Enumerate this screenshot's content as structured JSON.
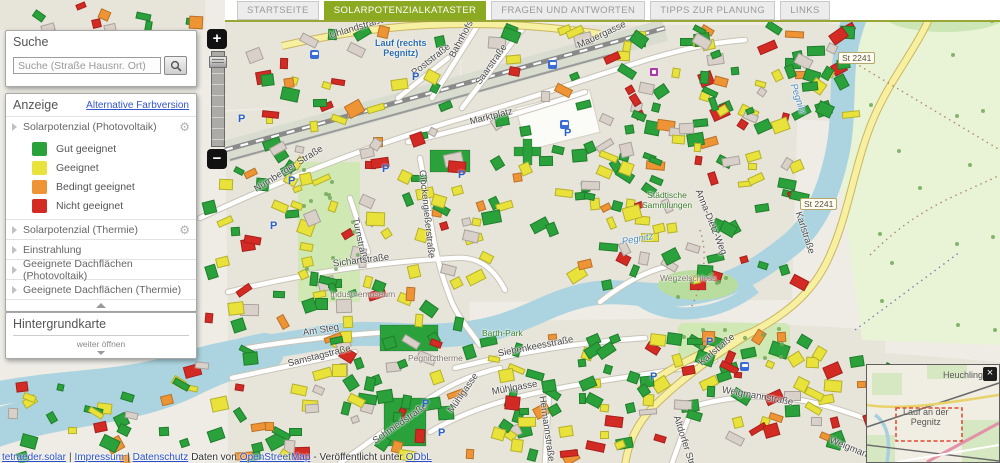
{
  "header": {
    "tabs": [
      {
        "label": "STARTSEITE",
        "active": false
      },
      {
        "label": "SOLARPOTENZIALKATASTER",
        "active": true
      },
      {
        "label": "FRAGEN UND ANTWORTEN",
        "active": false
      },
      {
        "label": "TIPPS ZUR PLANUNG",
        "active": false
      },
      {
        "label": "LINKS",
        "active": false
      }
    ]
  },
  "search": {
    "title": "Suche",
    "placeholder": "Suche (Straße Hausnr. Ort)"
  },
  "display_panel": {
    "title": "Anzeige",
    "alt_link": "Alternative Farbversion",
    "sections": [
      {
        "label": "Solarpotenzial (Photovoltaik)",
        "gear": true
      },
      {
        "label": "Solarpotenzial (Thermie)",
        "gear": true
      },
      {
        "label": "Einstrahlung",
        "gear": false
      },
      {
        "label": "Geeignete Dachflächen (Photovoltaik)",
        "gear": false
      },
      {
        "label": "Geeignete Dachflächen (Thermie)",
        "gear": false
      }
    ],
    "legend": [
      {
        "label": "Gut geeignet",
        "color": "#2aa13a"
      },
      {
        "label": "Geeignet",
        "color": "#e8e23b"
      },
      {
        "label": "Bedingt geeignet",
        "color": "#ee9434"
      },
      {
        "label": "Nicht geeignet",
        "color": "#d42a24"
      }
    ]
  },
  "background_panel": {
    "title": "Hintergrundkarte",
    "more_hint": "weiter öffnen"
  },
  "zoom_control": {
    "zoom_in": "+",
    "zoom_out": "−"
  },
  "icons": {
    "gear": "⚙"
  },
  "minimap": {
    "close_label": "×",
    "labels": [
      {
        "t": "Heuchling",
        "x": 76,
        "y": 5
      },
      {
        "t": "Lauf an der\nPegnitz",
        "x": 36,
        "y": 42
      }
    ]
  },
  "attribution": {
    "items": [
      {
        "t": "tetraeder.solar",
        "link": true
      },
      {
        "t": "|",
        "link": false
      },
      {
        "t": "Impressum",
        "link": true
      },
      {
        "t": "|",
        "link": false
      },
      {
        "t": "Datenschutz",
        "link": true
      },
      {
        "t": "Daten von",
        "link": false
      },
      {
        "t": "OpenStreetMap",
        "link": true
      },
      {
        "t": "- Veröffentlicht unter",
        "link": false
      },
      {
        "t": "ODbL",
        "link": true
      }
    ]
  },
  "map": {
    "parking_label": "P",
    "parking": [
      [
        238,
        120
      ],
      [
        288,
        182
      ],
      [
        270,
        227
      ],
      [
        382,
        170
      ],
      [
        458,
        176
      ],
      [
        564,
        134
      ],
      [
        412,
        78
      ],
      [
        706,
        343
      ],
      [
        650,
        378
      ],
      [
        422,
        405
      ],
      [
        438,
        434
      ]
    ],
    "bus_stops": [
      [
        548,
        60
      ],
      [
        310,
        50
      ],
      [
        560,
        120
      ],
      [
        740,
        362
      ]
    ],
    "purple_pois": [
      [
        650,
        68
      ]
    ],
    "labels": [
      {
        "t": "Uhlandstraße",
        "x": 330,
        "y": 36,
        "r": -17,
        "c": "st"
      },
      {
        "t": "Lauf (rechts\nPegnitz)",
        "x": 375,
        "y": 48,
        "r": 0,
        "c": "stn"
      },
      {
        "t": "Poststraße",
        "x": 413,
        "y": 74,
        "r": -38,
        "c": "st"
      },
      {
        "t": "Bahnhofstraße",
        "x": 452,
        "y": 57,
        "r": -62,
        "c": "st"
      },
      {
        "t": "Saarstraße",
        "x": 478,
        "y": 84,
        "r": -55,
        "c": "st"
      },
      {
        "t": "Mauergasse",
        "x": 578,
        "y": 46,
        "r": -25,
        "c": "st"
      },
      {
        "t": "Marktplatz",
        "x": 470,
        "y": 122,
        "r": -14,
        "c": "st"
      },
      {
        "t": "Nürnberger Straße",
        "x": 255,
        "y": 190,
        "r": -32,
        "c": "st"
      },
      {
        "t": "Turnstraße",
        "x": 355,
        "y": 218,
        "r": 78,
        "c": "st"
      },
      {
        "t": "Glockengießerstraße",
        "x": 422,
        "y": 170,
        "r": 84,
        "c": "st"
      },
      {
        "t": "Sichartstraße",
        "x": 333,
        "y": 264,
        "r": -7,
        "c": "st"
      },
      {
        "t": "Industriemuseum",
        "x": 330,
        "y": 294,
        "r": 0,
        "c": "pgr"
      },
      {
        "t": "Am Steg",
        "x": 303,
        "y": 333,
        "r": -9,
        "c": "st"
      },
      {
        "t": "Samstagstraße",
        "x": 288,
        "y": 364,
        "r": -14,
        "c": "st"
      },
      {
        "t": "Barth-Park",
        "x": 482,
        "y": 333,
        "r": 0,
        "c": "pg"
      },
      {
        "t": "Siebenkeesstraße",
        "x": 498,
        "y": 354,
        "r": -11,
        "c": "st"
      },
      {
        "t": "Pegnitztherme",
        "x": 408,
        "y": 358,
        "r": 0,
        "c": "pgr"
      },
      {
        "t": "Mühlgasse",
        "x": 450,
        "y": 412,
        "r": -55,
        "c": "st"
      },
      {
        "t": "Mühlgasse",
        "x": 492,
        "y": 392,
        "r": -10,
        "c": "st"
      },
      {
        "t": "Schmiedstraße",
        "x": 374,
        "y": 442,
        "r": -35,
        "c": "st"
      },
      {
        "t": "Hermannstraße",
        "x": 542,
        "y": 396,
        "r": 82,
        "c": "st"
      },
      {
        "t": "Karlstraße",
        "x": 700,
        "y": 364,
        "r": -40,
        "c": "st"
      },
      {
        "t": "Weigmannstraße",
        "x": 722,
        "y": 390,
        "r": 10,
        "c": "st"
      },
      {
        "t": "Weigmannstraße",
        "x": 830,
        "y": 440,
        "r": 22,
        "c": "st"
      },
      {
        "t": "Altdorfer Straße",
        "x": 676,
        "y": 416,
        "r": 72,
        "c": "st"
      },
      {
        "t": "Anna-Dietz-Weg",
        "x": 698,
        "y": 190,
        "r": 68,
        "c": "st"
      },
      {
        "t": "Karlstraße",
        "x": 798,
        "y": 212,
        "r": 72,
        "c": "st"
      },
      {
        "t": "Städtische\nSammlungen",
        "x": 642,
        "y": 200,
        "r": 0,
        "c": "pg"
      },
      {
        "t": "Wenzelschloss",
        "x": 660,
        "y": 278,
        "r": 0,
        "c": "pgr"
      },
      {
        "t": "Pegnitz",
        "x": 622,
        "y": 242,
        "r": -10,
        "c": "wt"
      },
      {
        "t": "Pegnitz",
        "x": 793,
        "y": 84,
        "r": 72,
        "c": "wt"
      },
      {
        "t": "St 2241",
        "x": 838,
        "y": 58,
        "r": 0,
        "c": "bdg"
      },
      {
        "t": "St 2241",
        "x": 800,
        "y": 204,
        "r": 0,
        "c": "bdg"
      }
    ]
  },
  "colors": {
    "active_tab": "#8caa21",
    "link": "#3355cc",
    "good": "#2aa13a",
    "suitable": "#e8e23b",
    "conditional": "#ee9434",
    "unsuitable": "#d42a24",
    "building_gray": "#d9d0c9",
    "water": "#abd4e0",
    "road_yellow": "#f6f0a0",
    "land": "#eeece5",
    "field": "#e9f4d6",
    "park": "#cfe8b4"
  }
}
